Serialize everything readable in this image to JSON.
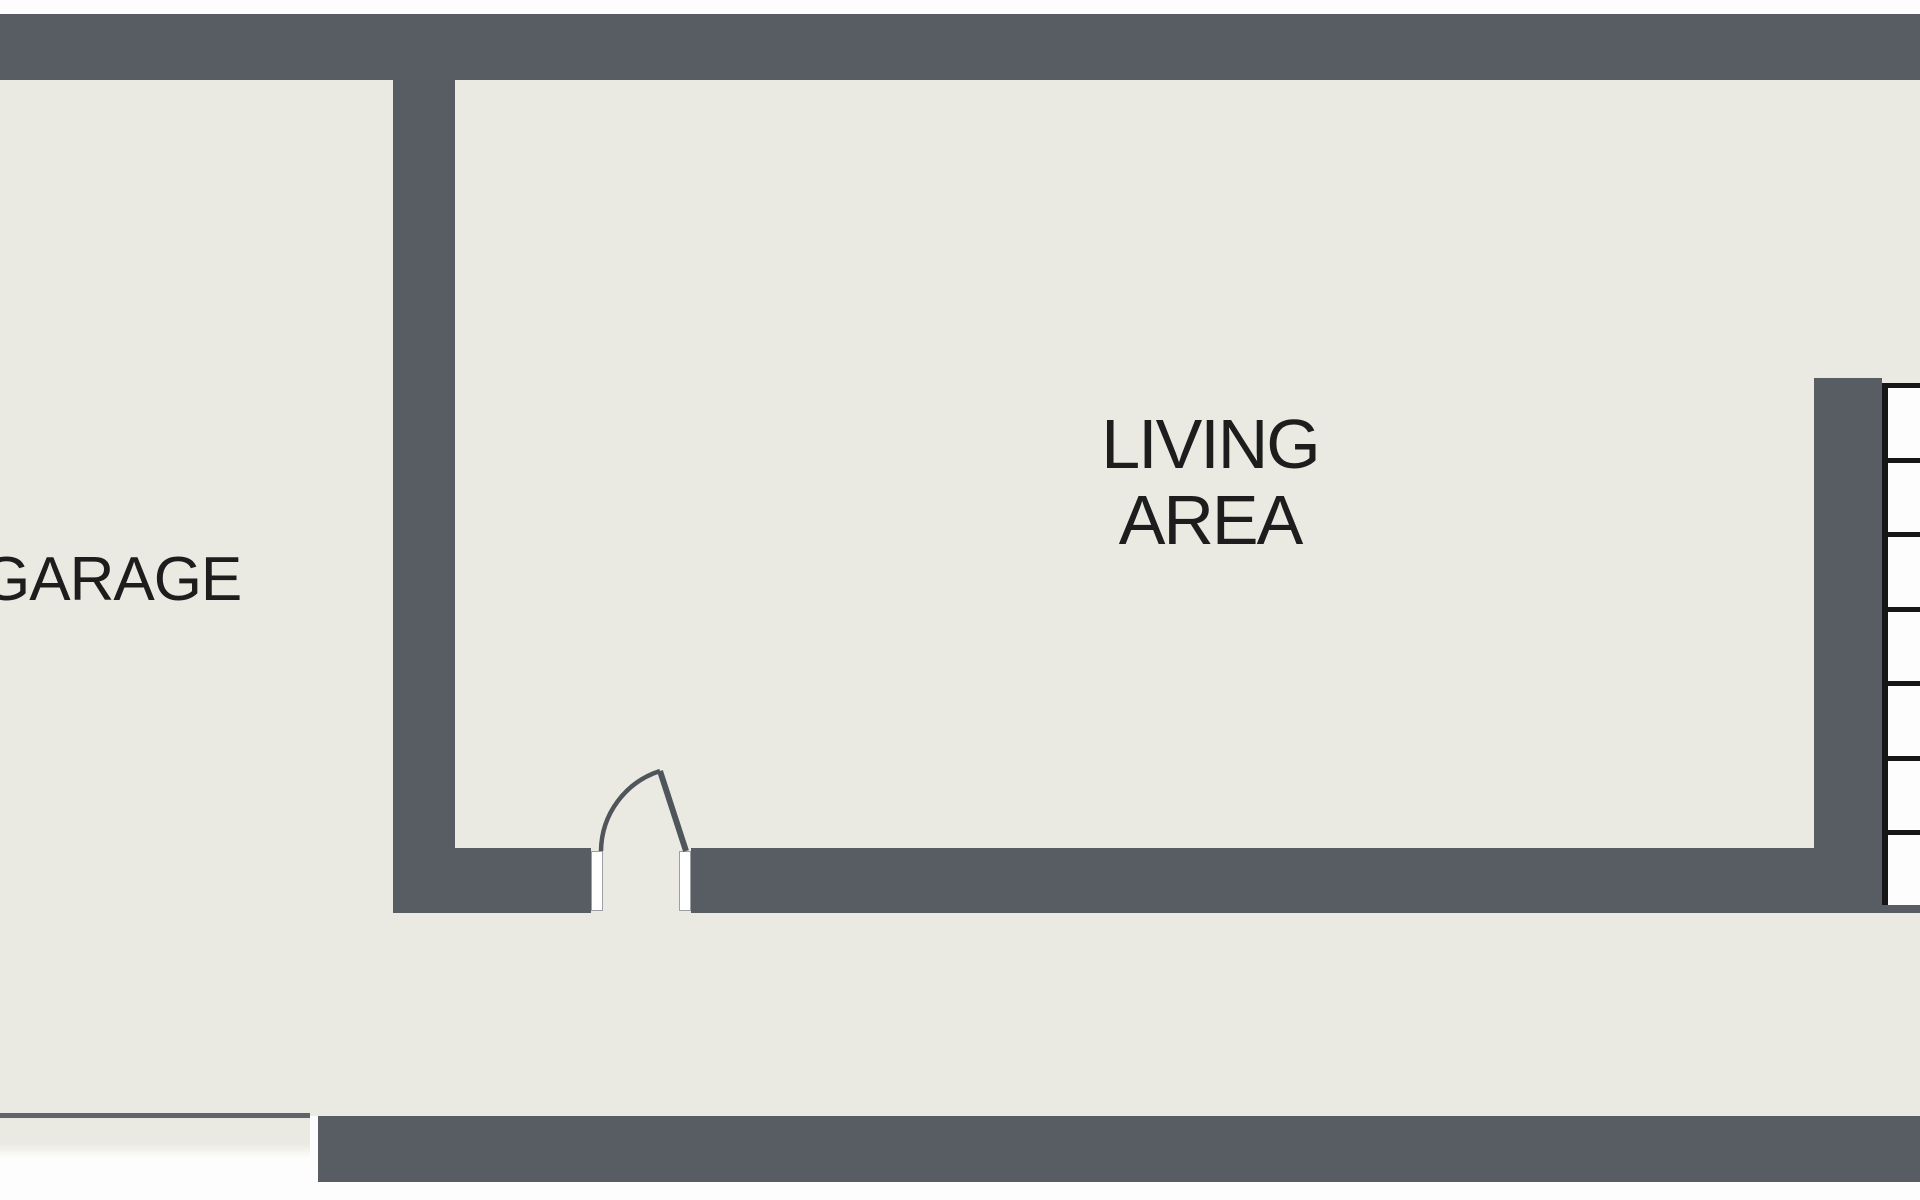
{
  "document_type": "floor-plan",
  "rooms": {
    "garage": {
      "label": "GARAGE"
    },
    "living": {
      "label_line1": "LIVING",
      "label_line2": "AREA"
    }
  },
  "stairs": {
    "tread_count": 7
  },
  "door": {
    "type": "swing-door",
    "opening_px": 100
  },
  "colors": {
    "wall": "#585d64",
    "floor": "#ebeae2",
    "line": "#161616",
    "stair_fill": "#fdfdfd",
    "door_stroke": "#50555b",
    "text": "#1d1d1d",
    "bg": "#fdfdfd",
    "garage_line": "#60656b"
  }
}
